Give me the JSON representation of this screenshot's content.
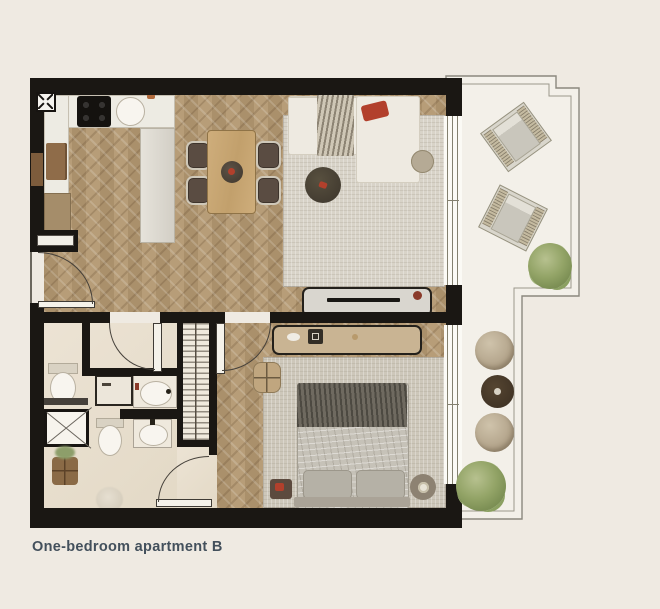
{
  "caption": {
    "text": "One-bedroom apartment B",
    "color": "#43505c"
  },
  "palette": {
    "background": "#efeae2",
    "wall": "#1a1713",
    "wood_floor": "#b39871",
    "bathroom_floor": "#e9e0d0",
    "balcony_floor": "#f3f0e9",
    "living_rug": "#d8d3c8",
    "bedroom_rug": "#cdc7ba",
    "accent_red": "#b2402c",
    "caption_text": "#43505c"
  }
}
